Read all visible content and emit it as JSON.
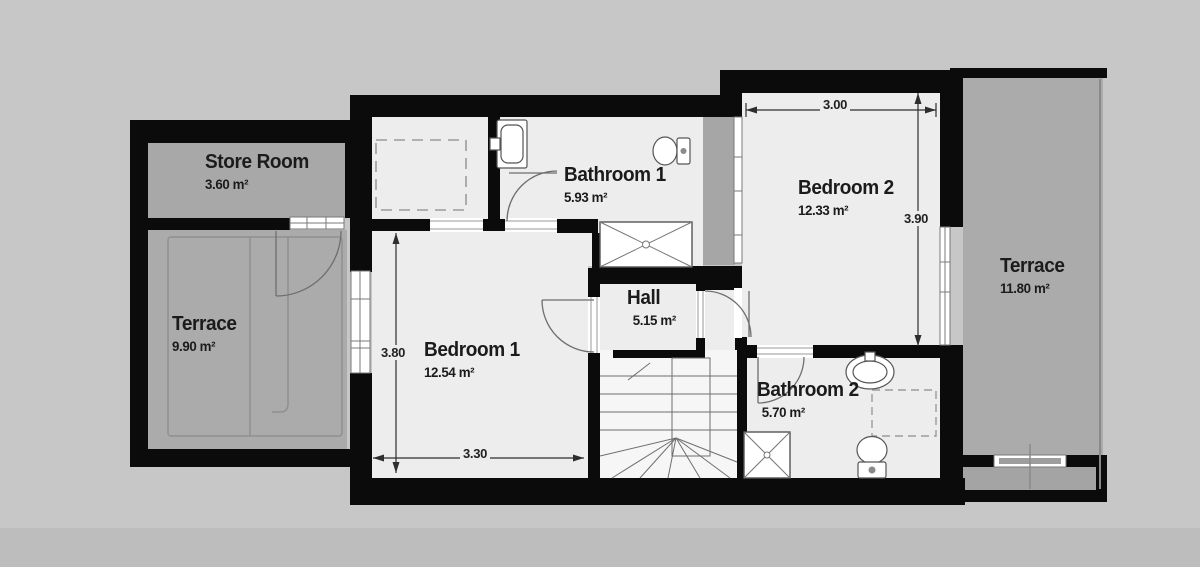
{
  "title": "Upper floor plan",
  "rooms": [
    {
      "id": "store-room",
      "label": "Store Room",
      "area": "3.60 m²"
    },
    {
      "id": "terrace-left",
      "label": "Terrace",
      "area": "9.90 m²"
    },
    {
      "id": "bedroom-1",
      "label": "Bedroom 1",
      "area": "12.54 m²"
    },
    {
      "id": "bathroom-1",
      "label": "Bathroom 1",
      "area": "5.93 m²"
    },
    {
      "id": "hall",
      "label": "Hall",
      "area": "5.15 m²"
    },
    {
      "id": "bedroom-2",
      "label": "Bedroom 2",
      "area": "12.33 m²"
    },
    {
      "id": "bathroom-2",
      "label": "Bathroom 2",
      "area": "5.70 m²"
    },
    {
      "id": "terrace-right",
      "label": "Terrace",
      "area": "11.80 m²"
    }
  ],
  "dimensions": [
    {
      "id": "bedroom2-width",
      "value": "3.00"
    },
    {
      "id": "bedroom2-height",
      "value": "3.90"
    },
    {
      "id": "bedroom1-height",
      "value": "3.80"
    },
    {
      "id": "bedroom1-width",
      "value": "3.30"
    }
  ],
  "colors": {
    "background": "#c7c7c7",
    "background_band": "#bdbdbd",
    "wall": "#0b0b0b",
    "indoor_floor": "#ededed",
    "stairs_floor": "#f6f6f6",
    "outdoor_floor": "#ababab",
    "line_gray": "#6e6e6e",
    "dashed_gray": "#9b9b9b",
    "text": "#1b1b1b"
  },
  "fixtures": {
    "bathroom1": [
      "sink",
      "toilet",
      "shower"
    ],
    "bathroom2": [
      "sink",
      "toilet",
      "shower",
      "appliance-space"
    ],
    "bedroom1": [
      "wardrobe-dashed"
    ],
    "circulation": [
      "winder-staircase"
    ]
  }
}
